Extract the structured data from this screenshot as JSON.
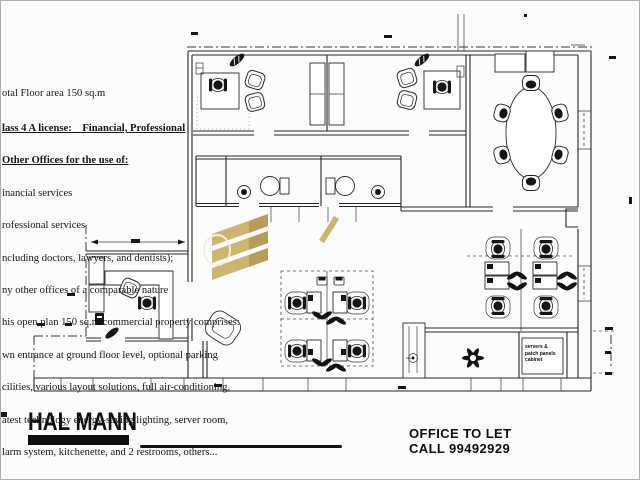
{
  "notes": {
    "lines": [
      "otal Floor area 150 sq.m",
      "lass 4 A license:    Financial, Professional",
      "Other Offices for the use of:",
      "inancial services",
      "rofessional services",
      "ncluding doctors, lawyers, and dentists);",
      "ny other offices of a comparable nature",
      "his open plan 150 sq.m commercial property comprises:",
      "wn entrance at ground floor level, optional parking",
      "cilities, various layout solutions, full air-conditioning,",
      "atest technology energy-saving lighting, server room,",
      "larm system, kitchenette, and 2 restrooms, others..."
    ]
  },
  "branding": {
    "logo_text": "HAL MANN"
  },
  "contact": {
    "offer": "OFFICE TO LET",
    "phone": "CALL 99492929"
  },
  "plan": {
    "server_cabinet_label": [
      "servers &",
      "patch panels",
      "cabinet"
    ],
    "colors": {
      "ink": "#262626",
      "gold": "#c8ae66",
      "gold_dark": "#b2954f"
    }
  }
}
